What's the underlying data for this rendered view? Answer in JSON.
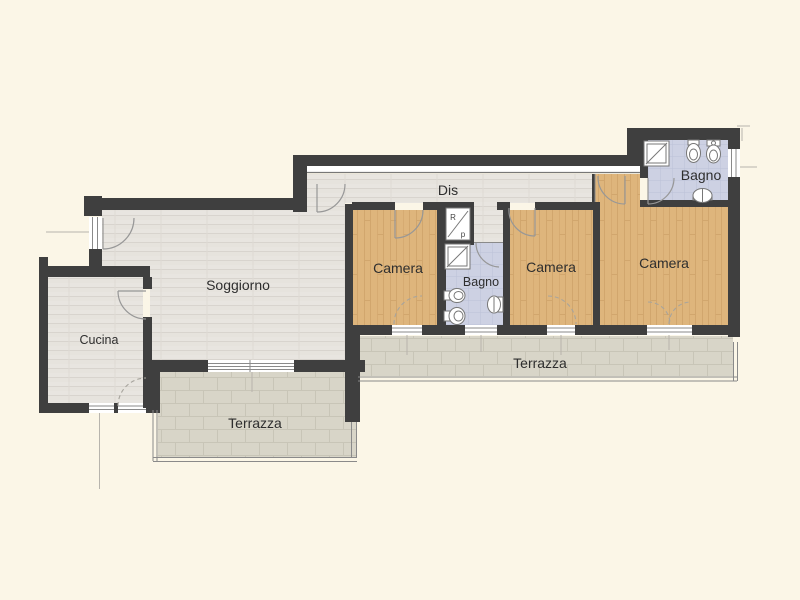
{
  "title": "Apartment floor plan",
  "rooms": {
    "soggiorno": {
      "label": "Soggiorno"
    },
    "cucina": {
      "label": "Cucina"
    },
    "dis": {
      "label": "Dis"
    },
    "camera_1": {
      "label": "Camera"
    },
    "camera_2": {
      "label": "Camera"
    },
    "camera_3": {
      "label": "Camera"
    },
    "bagno_1": {
      "label": "Bagno"
    },
    "bagno_2": {
      "label": "Bagno"
    },
    "terrazza_left": {
      "label": "Terrazza"
    },
    "terrazza_right": {
      "label": "Terrazza"
    },
    "ripostiglio": {
      "letter_top": "R",
      "letter_bottom": "p"
    }
  },
  "icons": {
    "fixtures": [
      "shower-icon",
      "toilet-icon",
      "bidet-icon",
      "sink-icon"
    ],
    "symbols": [
      "door-swing-arc",
      "french-door-dashed-arc",
      "window-glazing-lines"
    ]
  },
  "colors": {
    "background": "#fbf6e7",
    "wall": "#3f3f3f",
    "wood_light": "#e8e5e0",
    "wood_warm": "#deb57c",
    "bath_tile": "#cdd1e3",
    "terrace_tile": "#d8d5c8",
    "thin_line": "#8a8a8a",
    "fixture_stroke": "#777777"
  }
}
